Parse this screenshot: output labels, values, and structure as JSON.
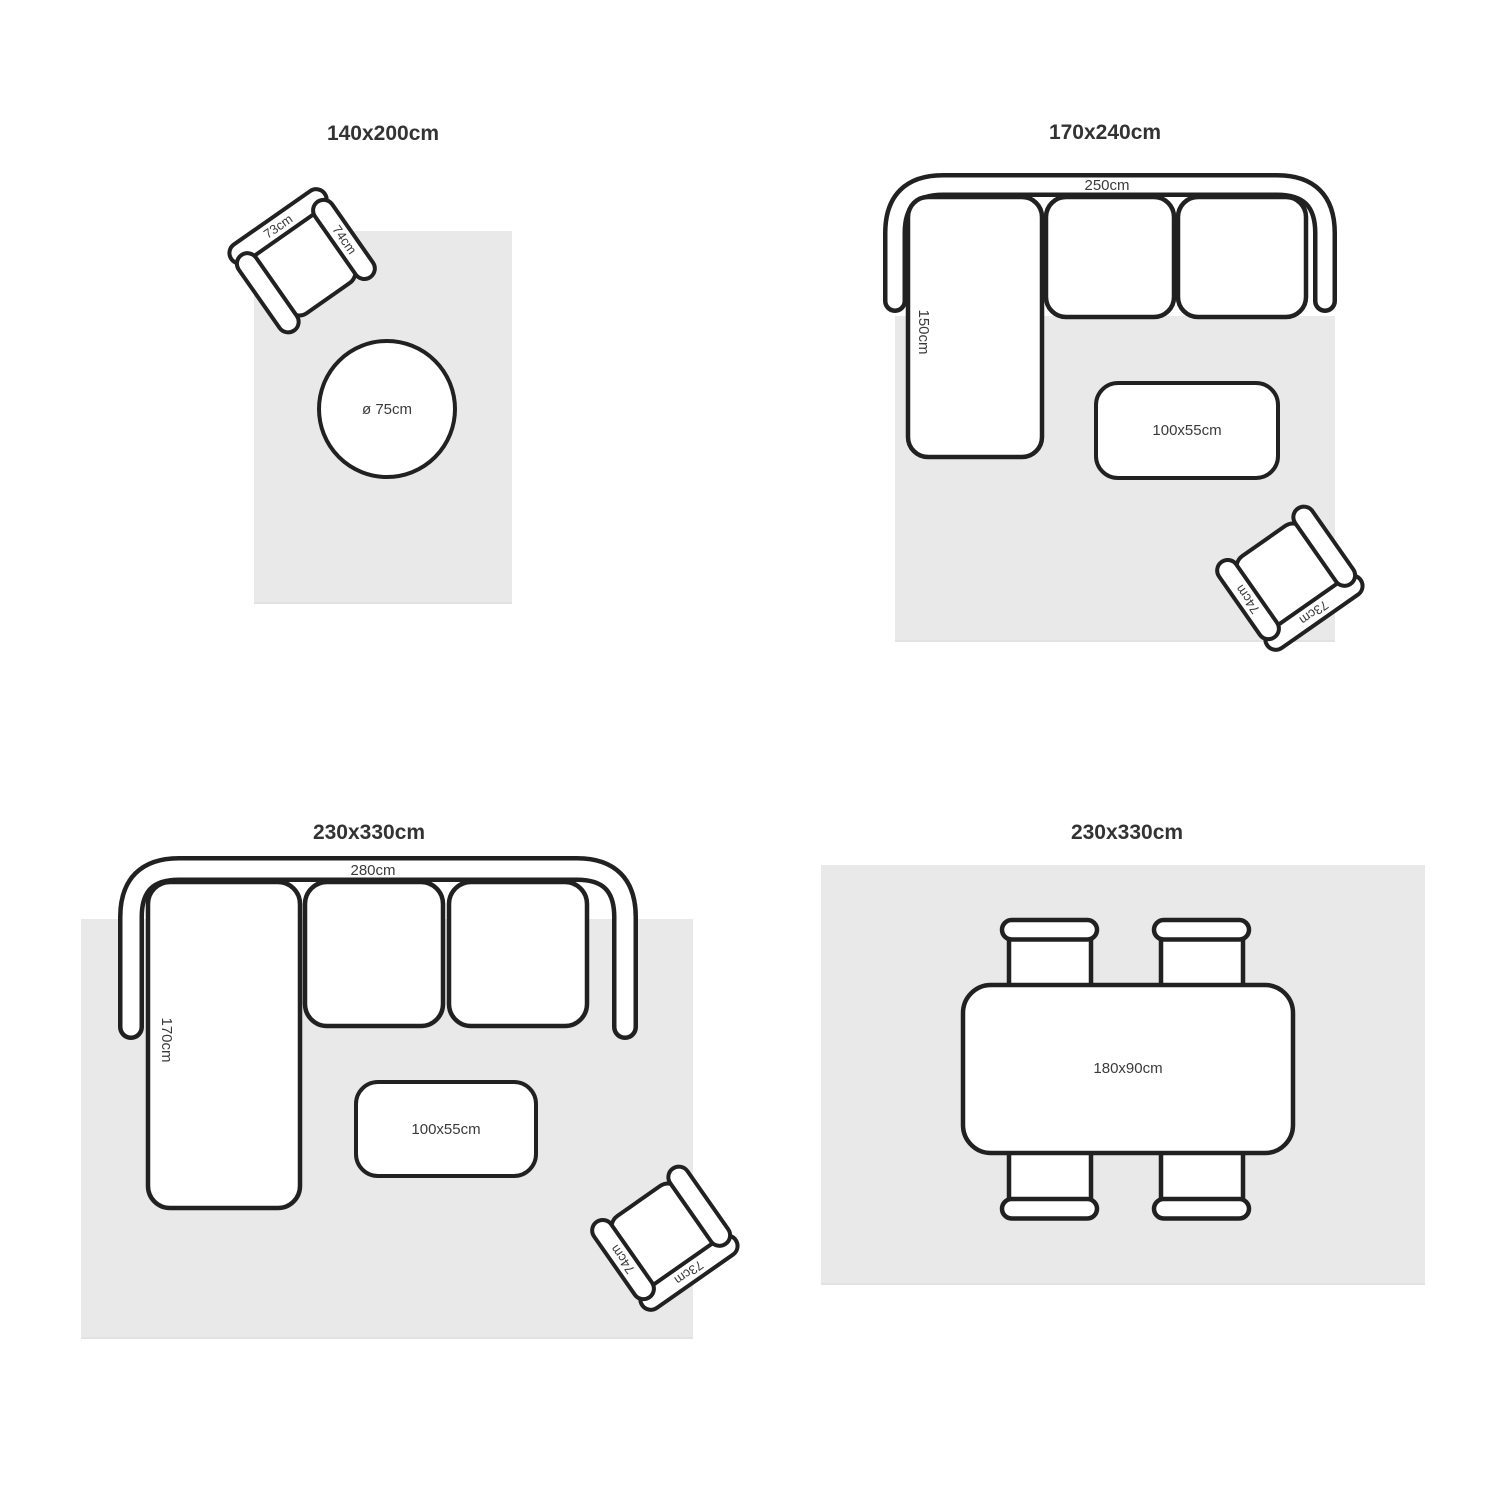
{
  "colors": {
    "rug": "#e9e9e9",
    "stroke": "#212121",
    "text": "#333333",
    "background": "#ffffff"
  },
  "panels": [
    {
      "title": "140x200cm",
      "armchair": {
        "back_label": "73cm",
        "arm_label": "74cm"
      },
      "round_table": {
        "label": "ø 75cm"
      }
    },
    {
      "title": "170x240cm",
      "sofa": {
        "width_label": "250cm",
        "depth_label": "150cm"
      },
      "coffee_table": {
        "label": "100x55cm"
      },
      "armchair": {
        "back_label": "73cm",
        "arm_label": "74cm"
      }
    },
    {
      "title": "230x330cm",
      "sofa": {
        "width_label": "280cm",
        "depth_label": "170cm"
      },
      "coffee_table": {
        "label": "100x55cm"
      },
      "armchair": {
        "back_label": "73cm",
        "arm_label": "74cm"
      }
    },
    {
      "title": "230x330cm",
      "dining_table": {
        "label": "180x90cm"
      }
    }
  ]
}
